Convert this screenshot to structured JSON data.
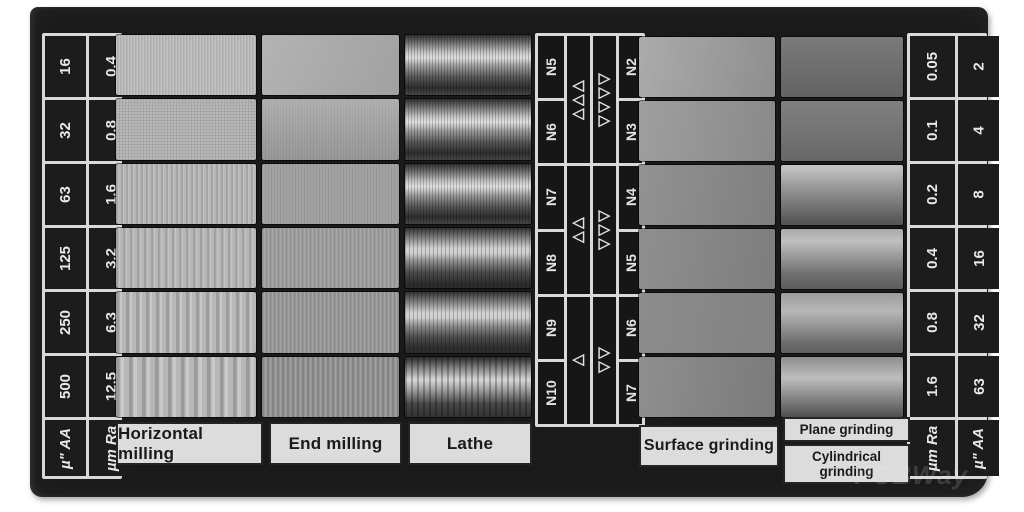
{
  "watermark": "PCBWay",
  "scales": {
    "left": {
      "outer_label": "µ\" AA",
      "inner_label": "µm Ra",
      "outer_values": [
        "16",
        "32",
        "63",
        "125",
        "250",
        "500"
      ],
      "inner_values": [
        "0.4",
        "0.8",
        "1.6",
        "3.2",
        "6.3",
        "12.5"
      ]
    },
    "right": {
      "inner_label": "µm Ra",
      "outer_label": "µ\" AA",
      "inner_values": [
        "0.05",
        "0.1",
        "0.2",
        "0.4",
        "0.8",
        "1.6"
      ],
      "outer_values": [
        "2",
        "4",
        "8",
        "16",
        "32",
        "63"
      ]
    }
  },
  "grades": {
    "left": [
      "N5",
      "N6",
      "N7",
      "N8",
      "N9",
      "N10"
    ],
    "right": [
      "N2",
      "N3",
      "N4",
      "N5",
      "N6",
      "N7"
    ],
    "left_triangle_groups": [
      3,
      2,
      1
    ],
    "right_triangle_groups": [
      4,
      3,
      2
    ],
    "left_triangle_glyph": "◁",
    "right_triangle_glyph": "▷"
  },
  "processes": {
    "left": [
      "Horizontal milling",
      "End milling",
      "Lathe"
    ],
    "right_single": "Surface grinding",
    "right_stacked": [
      "Plane grinding",
      "Cylindrical grinding"
    ]
  }
}
